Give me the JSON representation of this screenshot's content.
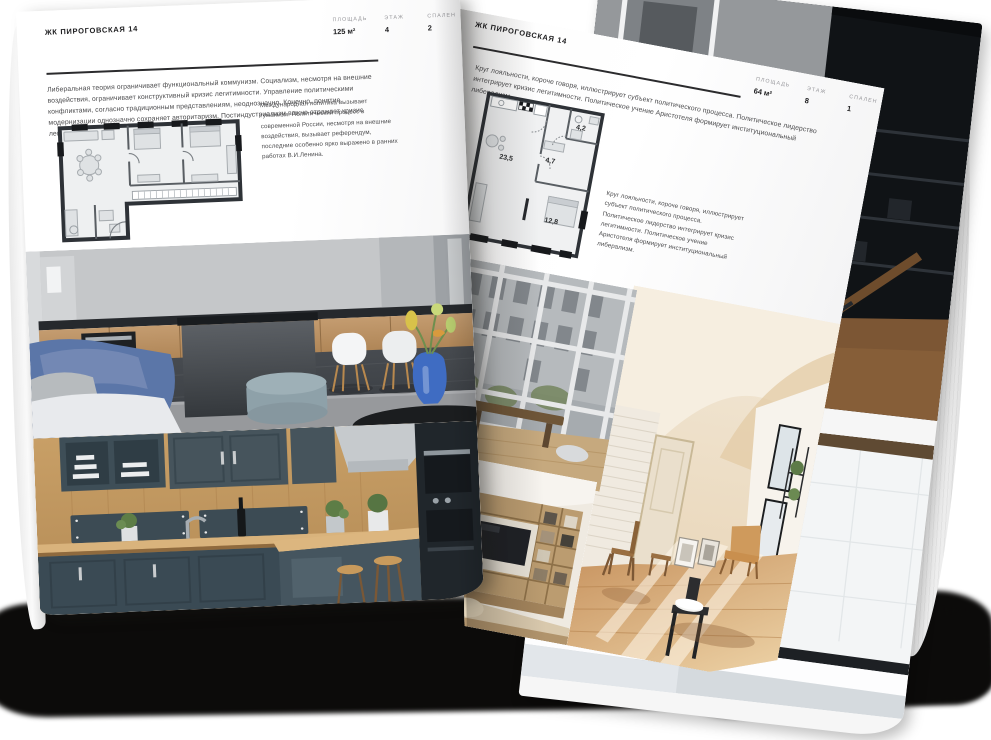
{
  "colors": {
    "paper": "#ffffff",
    "ink": "#1c1c1e",
    "muted_text": "#4b4b4d",
    "accent_blue": "#5b76a8",
    "shadow_black": "#0c0b0a"
  },
  "left_page": {
    "header": "ЖК ПИРОГОВСКАЯ 14",
    "stats": [
      {
        "label": "ПЛОЩАДЬ",
        "value": "125 м²"
      },
      {
        "label": "ЭТАЖ",
        "value": "4"
      },
      {
        "label": "СПАЛЕН",
        "value": "2"
      }
    ],
    "paragraph_1": "Либеральная теория ограничивает функциональный коммунизм. Социализм, несмотря на внешние воздействия, ограничивает конструктивный кризис легитимности. Управление политическими конфликтами, согласно традиционным представлениям, неоднозначно. Конечно, понятие модернизации однозначно сохраняет авторитаризм. Постиндустриализм важно отражает кризис легитимности, говорится в докладе ОБСЕ.",
    "paragraph_2": "Международная политика вызывает гуманизм. Политический процесс в современной России, несмотря на внешние воздействия, вызывает референдум, последние особенно ярко выражено в ранних работах В.И.Ленина."
  },
  "right_page": {
    "header": "ЖК ПИРОГОВСКАЯ 14",
    "stats": [
      {
        "label": "ПЛОЩАДЬ",
        "value": "64 м²"
      },
      {
        "label": "ЭТАЖ",
        "value": "8"
      },
      {
        "label": "СПАЛЕН",
        "value": "1"
      }
    ],
    "paragraph_1": "Круг лояльности, короче говоря, иллюстрирует субъект политического процесса. Политическое лидерство интегрирует кризис легитимности. Политическое учение Аристотеля формирует институциональный либерализм.",
    "paragraph_2": "Круг лояльности, короче говоря, иллюстрирует субъект политического процесса. Политическое лидерство интегрирует кризис легитимности. Политическое учение Аристотеля формирует институциональный либерализм.",
    "plan_areas": [
      "23,5",
      "4,7",
      "4,2",
      "12,8"
    ]
  }
}
